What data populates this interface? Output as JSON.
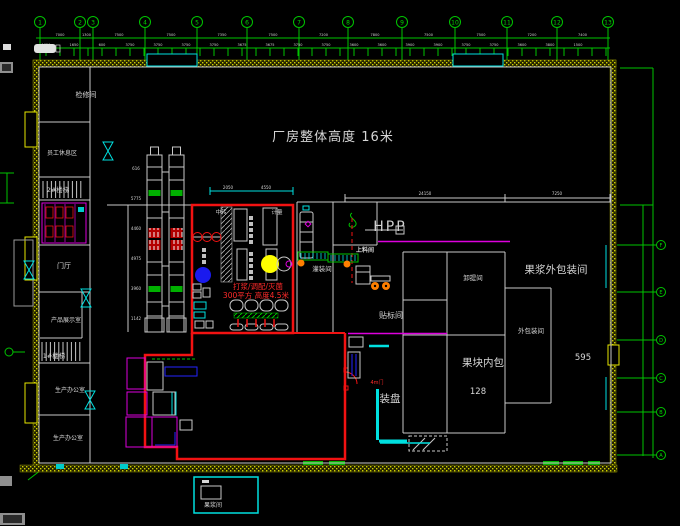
{
  "labels": {
    "title": "厂房整体高度 16米",
    "room_jianxiu": "检修间",
    "room_xiuxi": "员工休息区",
    "room_louti2": "2#楼梯",
    "room_menting": "门厅",
    "room_zhanshi": "产品展示室",
    "room_louti1": "1#楼梯",
    "room_bangong1": "生产办公室",
    "room_bangong2": "生产办公室",
    "zhongzhuan": "中转",
    "jiliang": "计量",
    "red_line1": "打浆/调配/灭菌",
    "red_line2": "300平方 高度4.5米",
    "hpp": "HPP",
    "shangliao": "上料间",
    "guanzhuang": "灌装间",
    "tiebiao": "贴标间",
    "xieti": "卸提间",
    "waibao_big": "果浆外包装间",
    "waibao_small": "外包装间",
    "neibao": "果块内包",
    "zhuangpan": "装盘",
    "door4m": "4m门",
    "guojiang_box": "果浆间",
    "num595": "595",
    "num128": "128"
  },
  "grid": {
    "top_axes": [
      {
        "n": "1",
        "x": 40
      },
      {
        "n": "2",
        "x": 80
      },
      {
        "n": "3",
        "x": 93
      },
      {
        "n": "4",
        "x": 145
      },
      {
        "n": "5",
        "x": 197
      },
      {
        "n": "6",
        "x": 247
      },
      {
        "n": "7",
        "x": 299
      },
      {
        "n": "8",
        "x": 348
      },
      {
        "n": "9",
        "x": 402
      },
      {
        "n": "10",
        "x": 455
      },
      {
        "n": "11",
        "x": 507
      },
      {
        "n": "12",
        "x": 557
      },
      {
        "n": "13",
        "x": 608
      }
    ],
    "right_axes": [
      {
        "n": "F",
        "y": 245
      },
      {
        "n": "E",
        "y": 292
      },
      {
        "n": "D",
        "y": 340
      },
      {
        "n": "C",
        "y": 378
      },
      {
        "n": "B",
        "y": 412
      },
      {
        "n": "A",
        "y": 455
      }
    ]
  },
  "dims": {
    "top_row1": [
      "7000",
      "1300",
      "7500",
      "7500",
      "7350",
      "7500",
      "7200",
      "7800",
      "7500",
      "7500",
      "7200",
      "7400"
    ],
    "top_row2": [
      "1650",
      "1650",
      "600",
      "3750",
      "3750",
      "3750",
      "3750",
      "3675",
      "3675",
      "3750",
      "3750",
      "3600",
      "3600",
      "3900",
      "3900",
      "3750",
      "3750",
      "3600",
      "3800",
      "1500"
    ],
    "tower_col": [
      "616",
      "5775",
      "4460",
      "4975",
      "3960",
      "1142"
    ],
    "inner_top": [
      "24150",
      "7250"
    ],
    "red_room_top": [
      "2050",
      "4550"
    ]
  },
  "colors": {
    "bg": "#000000",
    "grid_green": "#00c400",
    "line_white": "#c9c9c9",
    "wall_yellow": "#d6d600",
    "red": "#f21212",
    "cyan": "#00e0e0",
    "magenta": "#dd00dd",
    "blue": "#2424ff",
    "fill_yellow": "#ffff00",
    "orange": "#ff7f00"
  }
}
